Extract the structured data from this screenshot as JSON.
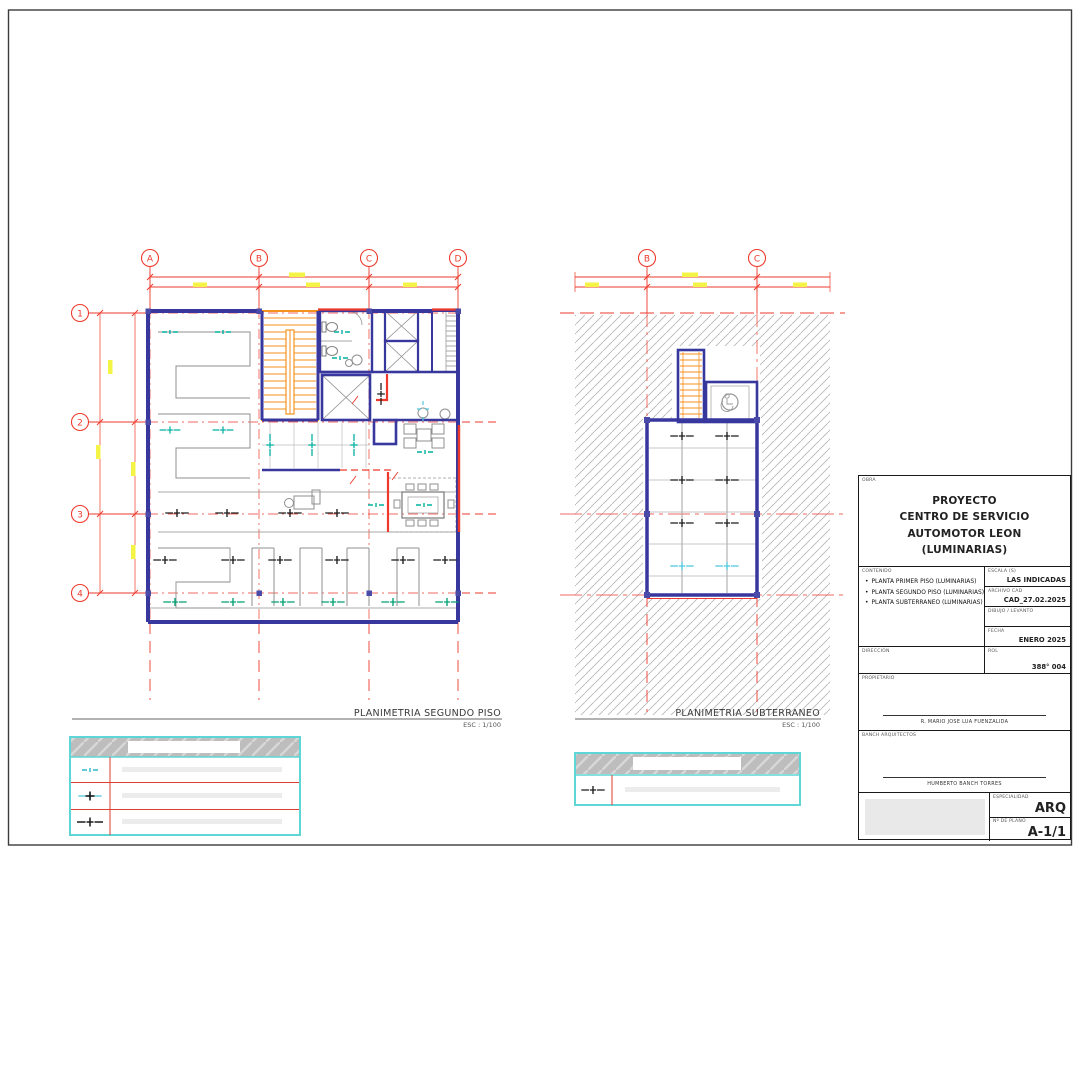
{
  "plans": [
    {
      "title": "PLANIMETRIA SEGUNDO PISO",
      "scale": "ESC : 1/100",
      "grid_cols": [
        "A",
        "B",
        "C",
        "D"
      ],
      "grid_rows": [
        "1",
        "2",
        "3",
        "4"
      ]
    },
    {
      "title": "PLANIMETRIA SUBTERRANEO",
      "scale": "ESC : 1/100",
      "grid_cols": [
        "B",
        "C"
      ]
    }
  ],
  "legends": {
    "table1_symbols": [
      "luminaria-teal-icon",
      "luminaria-cyan-black-icon",
      "luminaria-black-icon"
    ],
    "table2_symbols": [
      "luminaria-black-icon"
    ]
  },
  "title_block": {
    "obra_label": "OBRA",
    "project_line1": "PROYECTO",
    "project_line2": "CENTRO DE SERVICIO AUTOMOTOR LEON",
    "project_line3": "(LUMINARIAS)",
    "contenido_label": "CONTENIDO",
    "bullet": "•",
    "contenido_item1": "PLANTA PRIMER PISO (LUMINARIAS)",
    "contenido_item2": "PLANTA SEGUNDO PISO (LUMINARIAS)",
    "contenido_item3": "PLANTA SUBTERRANEO (LUMINARIAS)",
    "escala_label": "ESCALA (S)",
    "escala_value": "LAS INDICADAS",
    "archivo_label": "ARCHIVO CAD",
    "archivo_value": "CAD_27.02.2025",
    "dibujo_label": "DIBUJO / LEVANTO",
    "dibujo_value": "",
    "fecha_label": "FECHA",
    "fecha_value": "ENERO 2025",
    "direccion_label": "DIRECCIÓN",
    "direccion_value": "",
    "rol_label": "ROL",
    "rol_value": "388° 004",
    "propietario_label": "PROPIETARIO",
    "propietario_name": "R. MARIO JOSE LUA FUENZALIDA",
    "arquitectos_label": "BANCH ARQUITECTOS",
    "arquitecto_name": "HUMBERTO BANCH TORRES",
    "especialidad_label": "ESPECIALIDAD",
    "especialidad_value": "ARQ",
    "plano_label": "Nº DE PLANO",
    "plano_value": "A-1/1"
  },
  "colors": {
    "wall_blue": "#37379e",
    "grid_red": "#ee3a2c",
    "stair_orange": "#f5921e",
    "fixture_teal": "#00b0a0",
    "fixture_green": "#00a070",
    "fixture_black": "#1c1c1c",
    "legend_cyan": "#5fd6d6",
    "dim_yellow": "#f4f447"
  }
}
